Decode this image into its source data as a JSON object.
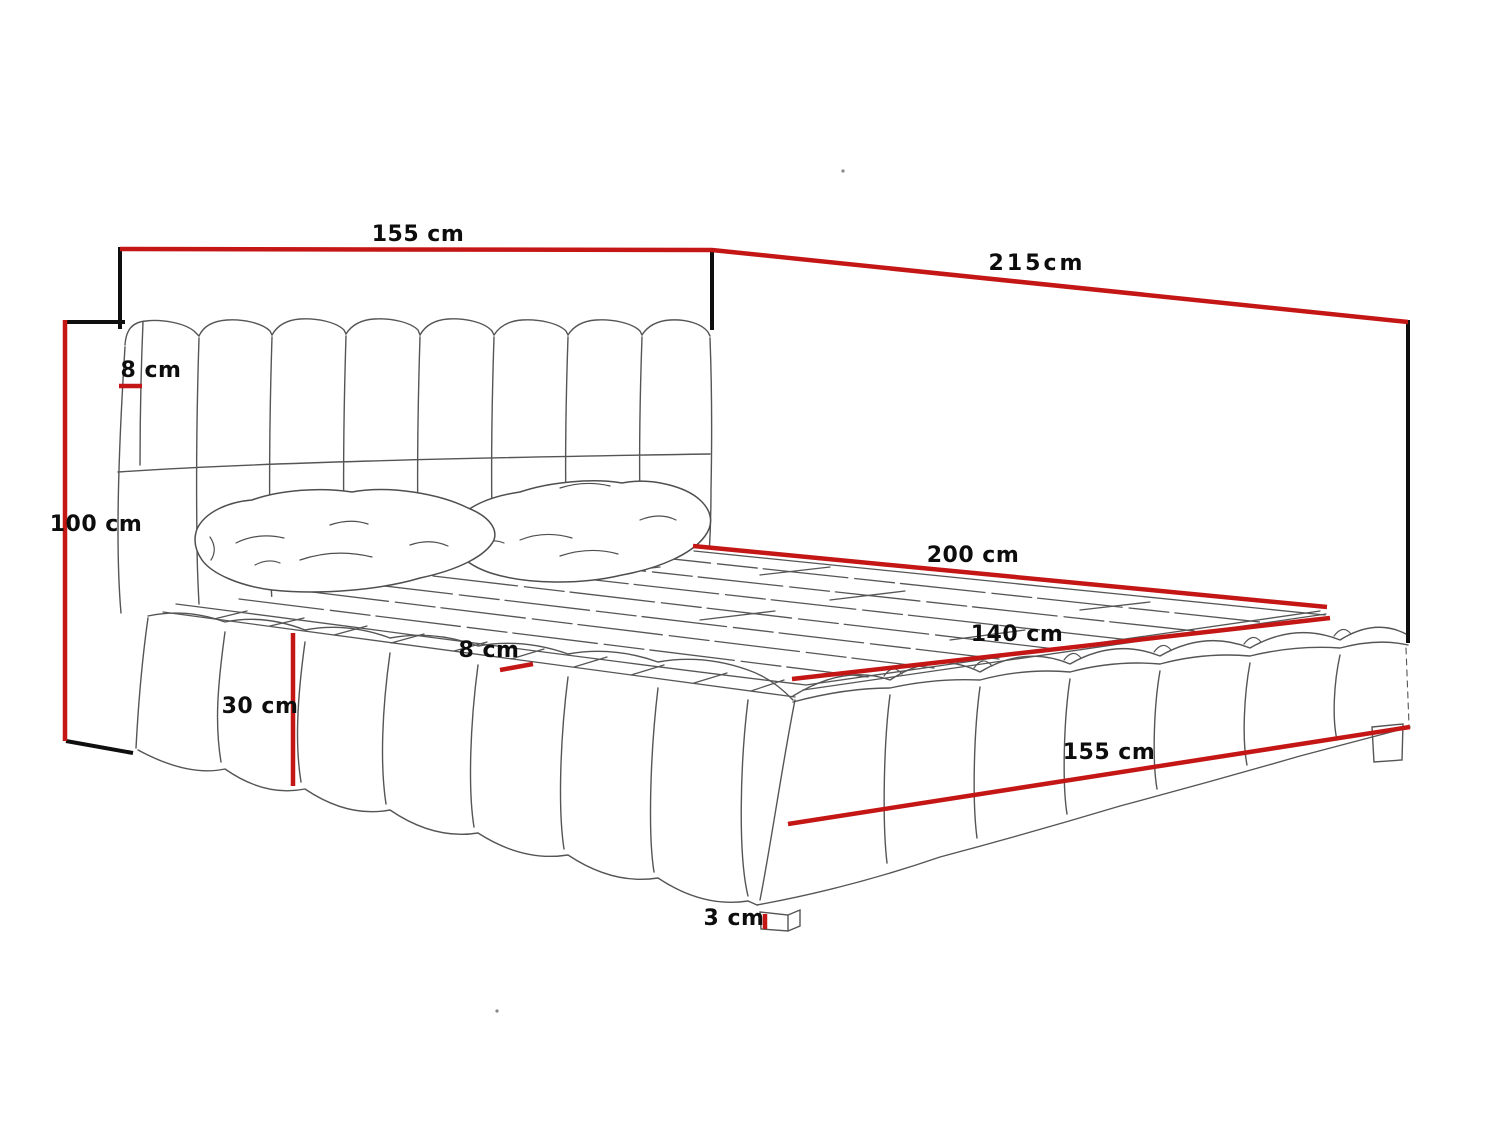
{
  "colors": {
    "red": "#c51616",
    "black": "#0f0f0f",
    "sketch": "#555555",
    "background": "#ffffff"
  },
  "labels": {
    "headboard_width": "155 cm",
    "bed_length": "215cm",
    "headboard_height": "100 cm",
    "headboard_panel_thickness": "8 cm",
    "mattress_length": "200 cm",
    "mattress_width": "140 cm",
    "frame_edge_thickness": "8 cm",
    "base_height": "30 cm",
    "bed_width": "155 cm",
    "leg_height": "3 cm"
  }
}
